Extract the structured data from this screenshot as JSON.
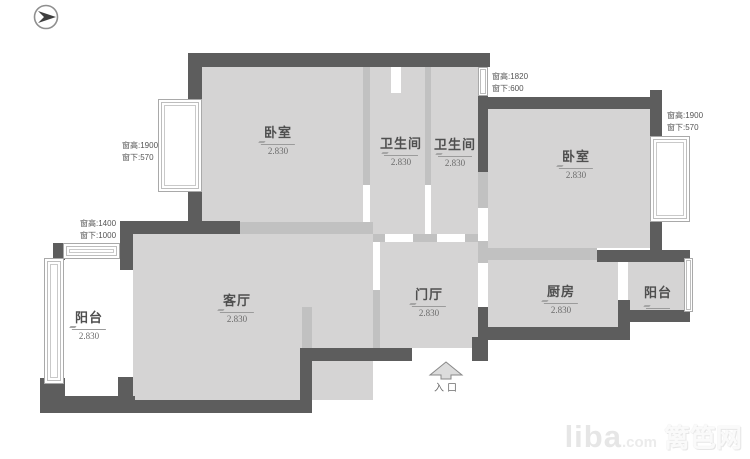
{
  "meta": {
    "title": "apartment floor plan",
    "canvas_width": 750,
    "canvas_height": 459
  },
  "colors": {
    "wall": "#5d5d5d",
    "partition": "#c1c1c1",
    "room_fill": "#d5d4d4",
    "label_text": "#4f4f4f",
    "annotation_text": "#555555",
    "watermark": "#e6e6e6"
  },
  "rooms": [
    {
      "id": "bedroom-left",
      "name": "卧室",
      "elevation": "2.830"
    },
    {
      "id": "bathroom-1",
      "name": "卫生间",
      "elevation": "2.830"
    },
    {
      "id": "bathroom-2",
      "name": "卫生间",
      "elevation": "2.830"
    },
    {
      "id": "bedroom-right",
      "name": "卧室",
      "elevation": "2.830"
    },
    {
      "id": "living-room",
      "name": "客厅",
      "elevation": "2.830"
    },
    {
      "id": "entry-hall",
      "name": "门厅",
      "elevation": "2.830"
    },
    {
      "id": "kitchen",
      "name": "厨房",
      "elevation": "2.830"
    },
    {
      "id": "balcony-right",
      "name": "阳台",
      "elevation": ""
    },
    {
      "id": "balcony-left",
      "name": "阳台",
      "elevation": "2.830"
    }
  ],
  "window_annotations": [
    {
      "id": "bedroom-left-window",
      "line1": "窗高:1900",
      "line2": "窗下:570"
    },
    {
      "id": "top-middle-window",
      "line1": "窗高:1820",
      "line2": "窗下:600"
    },
    {
      "id": "bedroom-right-window",
      "line1": "窗高:1900",
      "line2": "窗下:570"
    },
    {
      "id": "balcony-left-window",
      "line1": "窗高:1400",
      "line2": "窗下:1000"
    }
  ],
  "entrance": {
    "label": "入口"
  },
  "watermark": {
    "brand": "liba",
    "suffix": ".com",
    "cn_name": "篱笆网"
  }
}
